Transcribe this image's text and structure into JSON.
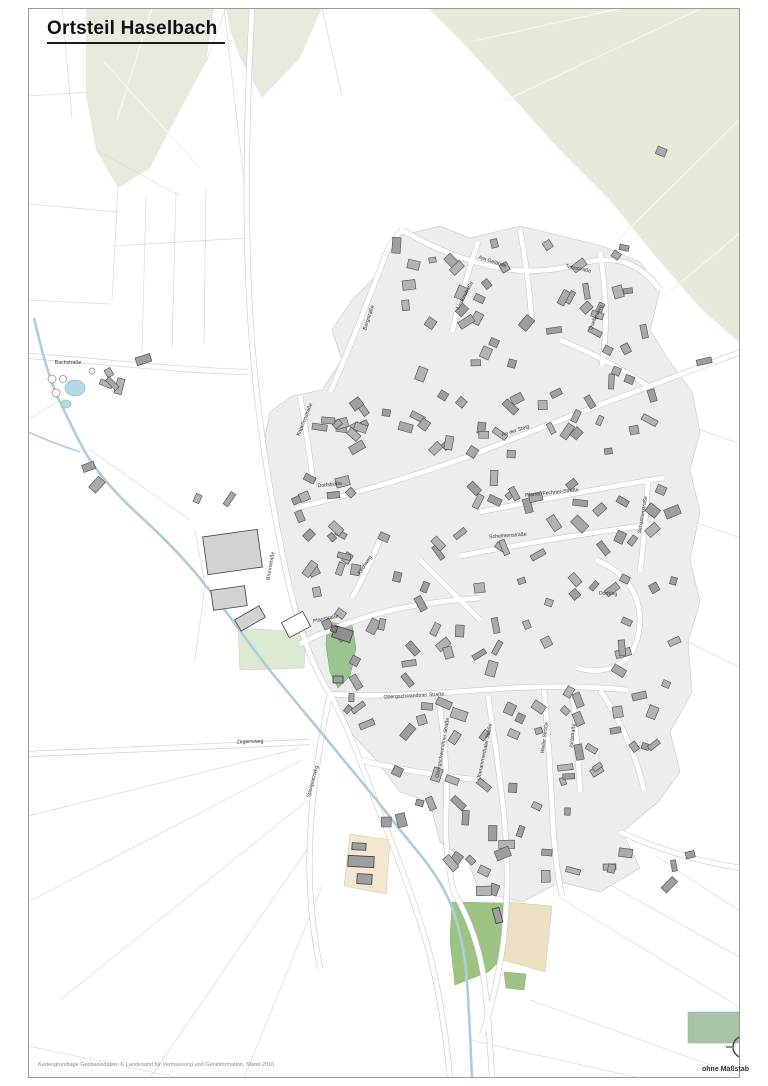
{
  "page": {
    "title": "Ortsteil Haselbach",
    "attribution": "Kartengrundlage Geobasisdaten: © Landesamt für Vermessung und Geoinformation, Stand 2016",
    "scale_note": "ohne Maßstab",
    "north_label": "N"
  },
  "colors": {
    "frame": "#9a9a9a",
    "forest": "#e7ebde",
    "forest_right": "#e5ead9",
    "village": "#ededed",
    "village_edge": "#c6c6c6",
    "road_casing": "#c9c9c9",
    "road_fill": "#ffffff",
    "field_line": "#d9d9d9",
    "forest_line": "#f4f6ed",
    "stream": "#a9cede",
    "pond_fill": "#b6d7e8",
    "pond_edge": "#8fb9d0",
    "building_fills": [
      "#a9a9a9",
      "#9e9e9e",
      "#b3b3b3"
    ],
    "building_edge": "#4c4c4c",
    "church_green": "#9cc491",
    "church_green_edge": "#79a86e",
    "cemetery_green": "#dcead2",
    "sport_green": "#9dc383",
    "legend_green": "#a7c3a8",
    "beige": "#f3e7d0",
    "beige_edge": "#dcc9a6",
    "label_color": "#333333"
  },
  "map": {
    "frame": {
      "x": 28,
      "y": 8,
      "w": 712,
      "h": 1070
    },
    "forest": [
      {
        "pts": "86,8 214,8 206,62 176,118 150,168 118,188 96,150 86,96",
        "fill": "#e7ebde"
      },
      {
        "pts": "226,8 322,8 300,58 262,98 240,58 230,30",
        "fill": "#e7ebde"
      },
      {
        "pts": "428,8 741,8 741,344 700,308 652,252 608,198 558,148 506,90 462,42",
        "fill": "#e5ead9"
      }
    ],
    "forest_lines": [
      "M470,42 L622,8",
      "M502,102 L702,8",
      "M618,240 L741,118",
      "M660,300 L741,232",
      "M104,62 L200,168",
      "M152,8 L117,120"
    ],
    "field_lines": [
      "M28,96 L88,92",
      "M62,8 L72,118",
      "M96,150 L180,196",
      "M118,188 L112,300",
      "M28,204 L118,212",
      "M112,246 L248,238",
      "M146,196 L142,352",
      "M176,192 L172,348",
      "M206,188 L204,344",
      "M28,300 L110,304",
      "M224,8 L246,198",
      "M246,198 L252,340",
      "M322,8 L342,96",
      "M206,62 L226,8",
      "M700,430 L741,444",
      "M688,520 L741,538",
      "M684,640 L741,668",
      "M560,898 L741,1008",
      "M598,878 L741,958",
      "M656,856 L741,912",
      "M530,1000 L741,1076",
      "M470,1040 L640,1078",
      "M300,748 L28,816",
      "M302,760 L28,902",
      "M308,800 L60,1000",
      "M312,842 L150,1078",
      "M322,886 L244,1078",
      "M28,1046 L180,1078",
      "M205,585 L195,660",
      "M195,530 L205,585",
      "M90,450 L190,520",
      "M60,400 L28,420"
    ],
    "village": "400,236 440,226 470,238 520,226 562,236 602,246 640,262 660,290 650,330 670,362 692,392 700,432 690,470 700,512 690,560 700,602 688,642 692,692 670,732 680,772 658,802 622,832 640,868 600,892 560,882 522,902 480,892 468,862 440,842 430,802 400,792 378,762 350,732 330,692 310,652 296,602 282,552 270,502 262,452 270,412 292,396 322,390 342,360 332,330 352,300 382,270 392,246",
    "green_areas": [
      {
        "pts": "327,622 352,625 356,648 350,676 338,688 330,672 326,645",
        "fill": "#9cc491",
        "stroke": "#79a86e"
      },
      {
        "pts": "238,628 306,632 304,668 240,670",
        "fill": "#dcead2",
        "stroke": "#c2d8b4"
      },
      {
        "pts": "452,902 505,903 503,958 488,972 455,985 450,940",
        "fill": "#9dc383",
        "stroke": "#8ab271"
      },
      {
        "pts": "504,972 526,974 524,990 506,988",
        "fill": "#9dc383",
        "stroke": "#8ab271"
      }
    ],
    "beige_areas": [
      {
        "pts": "350,834 390,840 386,894 344,886",
        "fill": "#f3e7d0",
        "stroke": "#dcc9a6"
      },
      {
        "pts": "507,902 552,906 545,972 503,960",
        "fill": "#ecdfc2",
        "stroke": "#d9cba4"
      }
    ],
    "roads": [
      "M252,8 C246,120 244,240 252,342 C258,420 268,482 282,552 C296,622 310,662 330,694 C348,726 362,766 378,808 C396,852 414,900 428,948 C440,992 446,1036 450,1078",
      "M28,356 C90,360 170,370 248,372",
      "M330,392 C352,344 368,300 386,254 C390,244 396,236 402,230",
      "M402,230 C440,252 470,262 500,268 C530,274 560,270 588,262 C616,256 640,262 660,290",
      "M600,252 C606,290 608,326 602,366",
      "M452,332 C460,300 468,272 478,242",
      "M296,508 C360,492 430,472 490,448 C540,428 590,408 640,390 C680,374 714,362 741,352",
      "M300,396 C306,428 310,458 314,488",
      "M480,512 C540,500 600,488 664,478",
      "M460,556 C520,544 580,534 656,524",
      "M648,478 C646,510 644,542 640,572",
      "M596,560 C626,572 646,598 638,636 C632,664 606,676 578,668",
      "M300,644 C330,628 360,618 392,610 C420,604 450,600 480,598",
      "M352,598 C364,576 374,556 382,534",
      "M330,694 C390,698 450,692 510,688 C550,686 590,686 628,690",
      "M438,694 C444,734 448,774 446,814 C445,842 448,868 454,892",
      "M488,696 C494,736 500,776 504,816 C508,856 508,896 504,936 C500,972 492,1004 482,1036",
      "M544,690 C548,730 550,768 552,806 C553,836 556,866 562,896",
      "M572,690 C576,724 578,758 580,792",
      "M330,694 C320,740 312,790 310,840 C308,884 312,928 320,968",
      "M28,754 C120,750 210,746 310,742",
      "M520,230 C526,262 530,294 532,326",
      "M560,340 C590,352 620,368 648,386",
      "M420,560 C440,580 460,600 480,620",
      "M600,690 C620,720 636,754 644,790",
      "M360,760 C400,770 440,776 480,780",
      "M620,832 C660,850 700,862 741,868",
      "M454,892 C470,920 480,950 484,980 C488,1010 490,1044 492,1078"
    ],
    "stream": "M34,318 C42,352 50,382 60,402 C68,418 74,432 84,450 C96,472 116,494 140,516 C164,538 186,560 206,586 C226,610 246,640 268,668 C292,698 318,728 342,758 C362,782 382,806 400,830 C418,852 436,872 448,898 C458,920 463,944 466,970 C469,1000 470,1036 472,1078",
    "stream_tributary": "M28,432 C46,440 62,446 80,452",
    "ponds": [
      {
        "cx": 75,
        "cy": 388,
        "rx": 10,
        "ry": 8
      },
      {
        "cx": 66,
        "cy": 404,
        "rx": 5,
        "ry": 4
      }
    ],
    "tanks": [
      {
        "cx": 52,
        "cy": 379,
        "r": 4
      },
      {
        "cx": 63,
        "cy": 379,
        "r": 3.5
      },
      {
        "cx": 56,
        "cy": 393,
        "r": 4
      },
      {
        "cx": 92,
        "cy": 371,
        "r": 3
      }
    ],
    "seed": 7,
    "building_clusters": [
      [
        395,
        240,
        120,
        85,
        16
      ],
      [
        525,
        245,
        120,
        90,
        16
      ],
      [
        300,
        395,
        95,
        75,
        13
      ],
      [
        400,
        335,
        125,
        130,
        20
      ],
      [
        530,
        345,
        125,
        120,
        17
      ],
      [
        295,
        475,
        120,
        85,
        14
      ],
      [
        425,
        470,
        130,
        85,
        15
      ],
      [
        560,
        480,
        115,
        85,
        12
      ],
      [
        305,
        565,
        110,
        90,
        12
      ],
      [
        420,
        565,
        135,
        90,
        14
      ],
      [
        560,
        575,
        115,
        80,
        11
      ],
      [
        345,
        660,
        120,
        95,
        14
      ],
      [
        470,
        665,
        125,
        90,
        13
      ],
      [
        600,
        665,
        85,
        85,
        9
      ],
      [
        385,
        765,
        110,
        70,
        11
      ],
      [
        500,
        765,
        110,
        70,
        9
      ],
      [
        425,
        840,
        110,
        55,
        8
      ],
      [
        545,
        830,
        70,
        50,
        5
      ],
      [
        620,
        840,
        75,
        45,
        4
      ],
      [
        80,
        358,
        70,
        50,
        5
      ],
      [
        85,
        465,
        45,
        25,
        2
      ],
      [
        190,
        490,
        45,
        30,
        2
      ],
      [
        700,
        350,
        20,
        15,
        1
      ],
      [
        650,
        145,
        14,
        10,
        1
      ]
    ],
    "special_buildings": [
      {
        "x": 205,
        "y": 533,
        "w": 55,
        "h": 38,
        "a": -8,
        "f": "#d2d2d2"
      },
      {
        "x": 212,
        "y": 588,
        "w": 34,
        "h": 20,
        "a": -8,
        "f": "#d2d2d2"
      },
      {
        "x": 236,
        "y": 612,
        "w": 28,
        "h": 13,
        "a": -30,
        "f": "#d2d2d2"
      },
      {
        "x": 284,
        "y": 616,
        "w": 24,
        "h": 17,
        "a": -28,
        "f": "#ffffff"
      },
      {
        "x": 333,
        "y": 628,
        "w": 19,
        "h": 12,
        "a": 18,
        "f": "#8f8f8f"
      },
      {
        "x": 331,
        "y": 626,
        "w": 6,
        "h": 6,
        "a": 18,
        "f": "#7d7d7d"
      },
      {
        "x": 333,
        "y": 676,
        "w": 10,
        "h": 7,
        "a": 0,
        "f": "#9e9e9e"
      },
      {
        "x": 352,
        "y": 843,
        "w": 14,
        "h": 7,
        "a": 3,
        "f": "#9f9f9f"
      },
      {
        "x": 348,
        "y": 856,
        "w": 26,
        "h": 11,
        "a": 3,
        "f": "#9f9f9f"
      },
      {
        "x": 357,
        "y": 874,
        "w": 15,
        "h": 10,
        "a": 3,
        "f": "#9f9f9f"
      },
      {
        "x": 494,
        "y": 908,
        "w": 7,
        "h": 15,
        "a": -15,
        "f": "#9e9e9e"
      }
    ],
    "labels": [
      {
        "t": "Bachstraße",
        "x": 68,
        "y": 364,
        "r": 0
      },
      {
        "t": "Bergstraße",
        "x": 370,
        "y": 318,
        "r": -72
      },
      {
        "t": "Am Gelände",
        "x": 492,
        "y": 263,
        "r": 18
      },
      {
        "t": "Tannstraße",
        "x": 578,
        "y": 270,
        "r": 12
      },
      {
        "t": "Quellenweg",
        "x": 597,
        "y": 318,
        "r": -65
      },
      {
        "t": "Lindenstraße",
        "x": 466,
        "y": 296,
        "r": -62
      },
      {
        "t": "Kapellenstraße",
        "x": 306,
        "y": 420,
        "r": -68
      },
      {
        "t": "An der Steig",
        "x": 516,
        "y": 432,
        "r": -18
      },
      {
        "t": "Dorfstraße",
        "x": 330,
        "y": 486,
        "r": -6
      },
      {
        "t": "Pfarrer-Fechner-Straße",
        "x": 552,
        "y": 494,
        "r": -6
      },
      {
        "t": "Schelmenstraße",
        "x": 508,
        "y": 537,
        "r": -4
      },
      {
        "t": "Sebastianstraße",
        "x": 644,
        "y": 515,
        "r": -80
      },
      {
        "t": "Dorfring",
        "x": 608,
        "y": 595,
        "r": 3
      },
      {
        "t": "Brunnstraße",
        "x": 272,
        "y": 566,
        "r": -80
      },
      {
        "t": "Pfarrstraße",
        "x": 326,
        "y": 620,
        "r": -12
      },
      {
        "t": "Kirchweg",
        "x": 366,
        "y": 566,
        "r": -55
      },
      {
        "t": "Obergschwandtner Straße",
        "x": 414,
        "y": 697,
        "r": -3
      },
      {
        "t": "Obergschwandtner Straße",
        "x": 444,
        "y": 748,
        "r": -80
      },
      {
        "t": "Oberammerthaler Straße",
        "x": 486,
        "y": 752,
        "r": -78
      },
      {
        "t": "Weiler Straße",
        "x": 546,
        "y": 738,
        "r": -82
      },
      {
        "t": "Jurastraße",
        "x": 574,
        "y": 736,
        "r": -82
      },
      {
        "t": "Sportplatzweg",
        "x": 314,
        "y": 782,
        "r": -75
      },
      {
        "t": "Zeglersweg",
        "x": 250,
        "y": 743,
        "r": -2
      }
    ],
    "legend_patch": {
      "x": 688,
      "y": 1012,
      "w": 62,
      "h": 31
    },
    "north_arrow": {
      "cx": 744,
      "cy": 1047,
      "r": 11
    }
  }
}
